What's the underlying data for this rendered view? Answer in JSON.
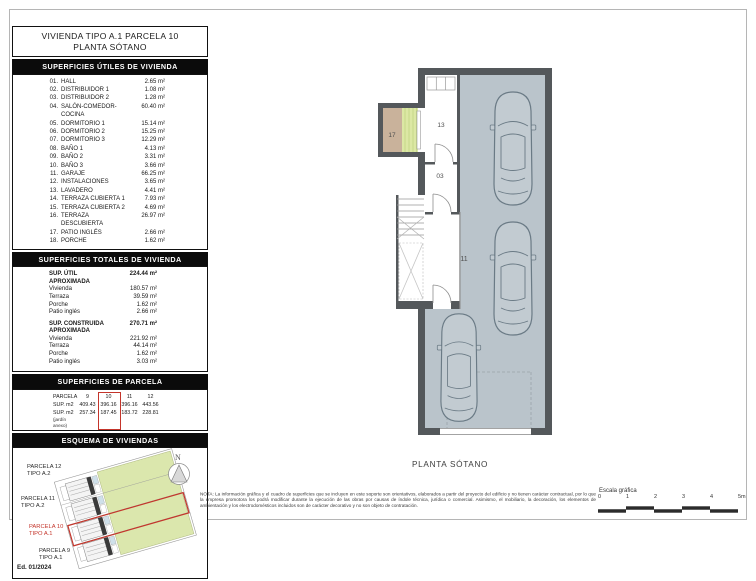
{
  "header": {
    "title_line1": "VIVIENDA TIPO A.1 PARCELA 10",
    "title_line2": "PLANTA SÓTANO"
  },
  "useful_surfaces": {
    "header": "SUPERFICIES ÚTILES DE VIVIENDA",
    "rows": [
      {
        "num": "01.",
        "label": "HALL",
        "value": "2.65 m²"
      },
      {
        "num": "02.",
        "label": "DISTRIBUIDOR 1",
        "value": "1.08 m²"
      },
      {
        "num": "03.",
        "label": "DISTRIBUIDOR 2",
        "value": "1.28 m²"
      },
      {
        "num": "04.",
        "label": "SALÓN-COMEDOR-COCINA",
        "value": "60.40 m²"
      },
      {
        "num": "05.",
        "label": "DORMITORIO 1",
        "value": "15.14 m²"
      },
      {
        "num": "06.",
        "label": "DORMITORIO 2",
        "value": "15.25 m²"
      },
      {
        "num": "07.",
        "label": "DORMITORIO 3",
        "value": "12.29 m²"
      },
      {
        "num": "08.",
        "label": "BAÑO 1",
        "value": "4.13 m²"
      },
      {
        "num": "09.",
        "label": "BAÑO 2",
        "value": "3.31 m²"
      },
      {
        "num": "10.",
        "label": "BAÑO 3",
        "value": "3.66 m²"
      },
      {
        "num": "11.",
        "label": "GARAJE",
        "value": "66.25 m²"
      },
      {
        "num": "12.",
        "label": "INSTALACIONES",
        "value": "3.65 m²"
      },
      {
        "num": "13.",
        "label": "LAVADERO",
        "value": "4.41 m²"
      },
      {
        "num": "14.",
        "label": "TERRAZA CUBIERTA 1",
        "value": "7.93 m²"
      },
      {
        "num": "15.",
        "label": "TERRAZA CUBIERTA 2",
        "value": "4.69 m²"
      },
      {
        "num": "16.",
        "label": "TERRAZA DESCUBIERTA",
        "value": "26.97 m²"
      },
      {
        "num": "17.",
        "label": "PATIO INGLÉS",
        "value": "2.66 m²"
      },
      {
        "num": "18.",
        "label": "PORCHE",
        "value": "1.62 m²"
      }
    ]
  },
  "total_surfaces": {
    "header": "SUPERFICIES TOTALES DE VIVIENDA",
    "groups": [
      {
        "label": "SUP. ÚTIL APROXIMADA",
        "value": "224.44 m²",
        "rows": [
          {
            "label": "Vivienda",
            "value": "180.57 m²"
          },
          {
            "label": "Terraza",
            "value": "39.59 m²"
          },
          {
            "label": "Porche",
            "value": "1.62 m²"
          },
          {
            "label": "Patio inglés",
            "value": "2.66 m²"
          }
        ]
      },
      {
        "label": "SUP. CONSTRUIDA APROXIMADA",
        "value": "270.71 m²",
        "rows": [
          {
            "label": "Vivienda",
            "value": "221.92 m²"
          },
          {
            "label": "Terraza",
            "value": "44.14 m²"
          },
          {
            "label": "Porche",
            "value": "1.62 m²"
          },
          {
            "label": "Patio inglés",
            "value": "3.03 m²"
          }
        ]
      }
    ]
  },
  "parcel_surfaces": {
    "header": "SUPERFICIES DE PARCELA",
    "corner_label": "PARCELA",
    "columns": [
      "9",
      "10",
      "11",
      "12"
    ],
    "highlighted_column": "10",
    "rows": [
      {
        "label": "SUP. m2",
        "sub": "",
        "cells": [
          "409.43",
          "396.16",
          "396.16",
          "443.56"
        ]
      },
      {
        "label": "SUP. m2",
        "sub": "(jardín anexo)",
        "cells": [
          "257.34",
          "187.45",
          "183.72",
          "228.81"
        ]
      }
    ]
  },
  "scheme": {
    "header": "ESQUEMA DE VIVIENDAS",
    "north_label": "N",
    "parcels": [
      {
        "label": "PARCELA 12",
        "type": "TIPO A.2",
        "highlight": false
      },
      {
        "label": "PARCELA 11",
        "type": "TIPO A.2",
        "highlight": false
      },
      {
        "label": "PARCELA 10",
        "type": "TIPO A.1",
        "highlight": true
      },
      {
        "label": "PARCELA 9",
        "type": "TIPO A.1",
        "highlight": false
      }
    ],
    "edition": "Ed. 01/2024"
  },
  "plan": {
    "caption": "PLANTA SÓTANO",
    "labels": {
      "patio_ingles": "17",
      "lavadero": "13",
      "distribuidor": "03",
      "garaje": "11"
    }
  },
  "footer": {
    "note": "NOTA: La información gráfica y el cuadro de superficies que se incluyen en este soporte son orientativos, elaborados a partir del proyecto del edificio y no tienen carácter contractual, por lo que la empresa promotora los podrá modificar durante la ejecución de las obras por causas de índole técnica, jurídica o comercial. Asimismo, el mobiliario, la decoración, los elementos de ambientación y los electrodomésticos incluidos son de carácter decorativo y no son objeto de contratación.",
    "scale_label": "Escala gráfica",
    "scale_ticks": [
      "0",
      "1",
      "2",
      "3",
      "4",
      "5m"
    ]
  },
  "colors": {
    "highlight_red": "#c4352b",
    "garage_floor": "#bac4cb",
    "wall_gray": "#54585b",
    "garden_green": "#dbe7ad",
    "patio_tan": "#c9b29b",
    "laundry_green": "#dce8a4"
  }
}
